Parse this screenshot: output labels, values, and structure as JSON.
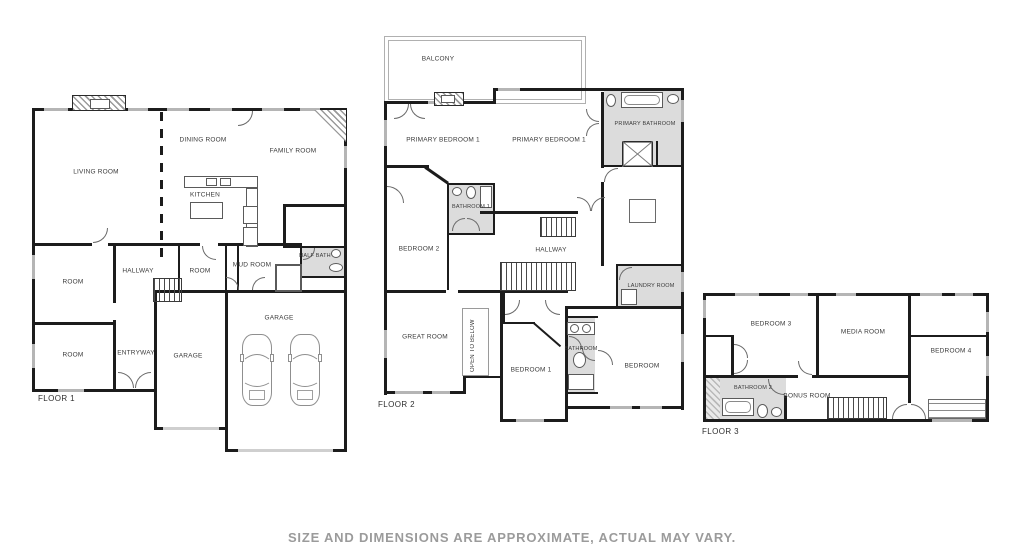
{
  "disclaimer": "SIZE AND DIMENSIONS ARE APPROXIMATE, ACTUAL MAY VARY.",
  "colors": {
    "wall": "#1c1c1c",
    "room_fill": "#ffffff",
    "bath_fill": "#dcdcdc",
    "window": "#b5b5b5",
    "label_text": "#3a3a3a",
    "disclaimer_text": "#9b9b9b"
  },
  "floor1": {
    "label": "FLOOR 1",
    "rooms": {
      "living_room": "LIVING ROOM",
      "dining_room": "DINING ROOM",
      "family_room": "FAMILY ROOM",
      "kitchen": "KITCHEN",
      "hallway": "HALLWAY",
      "room_upper": "ROOM",
      "room_left": "ROOM",
      "room_lower_left": "ROOM",
      "mud_room": "MUD ROOM",
      "half_bath": "HALF BATH",
      "entryway": "ENTRYWAY",
      "garage_left": "GARAGE",
      "garage_right": "GARAGE"
    }
  },
  "floor2": {
    "label": "FLOOR 2",
    "rooms": {
      "balcony": "BALCONY",
      "primary_bedroom_left": "PRIMARY BEDROOM 1",
      "primary_bedroom_right": "PRIMARY BEDROOM 1",
      "primary_bathroom": "PRIMARY BATHROOM",
      "bathroom_1": "BATHROOM 1",
      "bedroom_2": "BEDROOM 2",
      "hallway": "HALLWAY",
      "laundry_room": "LAUNDRY ROOM",
      "great_room": "GREAT ROOM",
      "open_to_below": "OPEN TO BELOW",
      "bedroom_1": "BEDROOM 1",
      "bathroom": "BATHROOM",
      "bedroom": "BEDROOM"
    }
  },
  "floor3": {
    "label": "FLOOR 3",
    "rooms": {
      "bedroom_3": "BEDROOM 3",
      "media_room": "MEDIA ROOM",
      "bedroom_4": "BEDROOM 4",
      "bathroom_2": "BATHROOM 2",
      "bonus_room": "BONUS ROOM"
    }
  }
}
